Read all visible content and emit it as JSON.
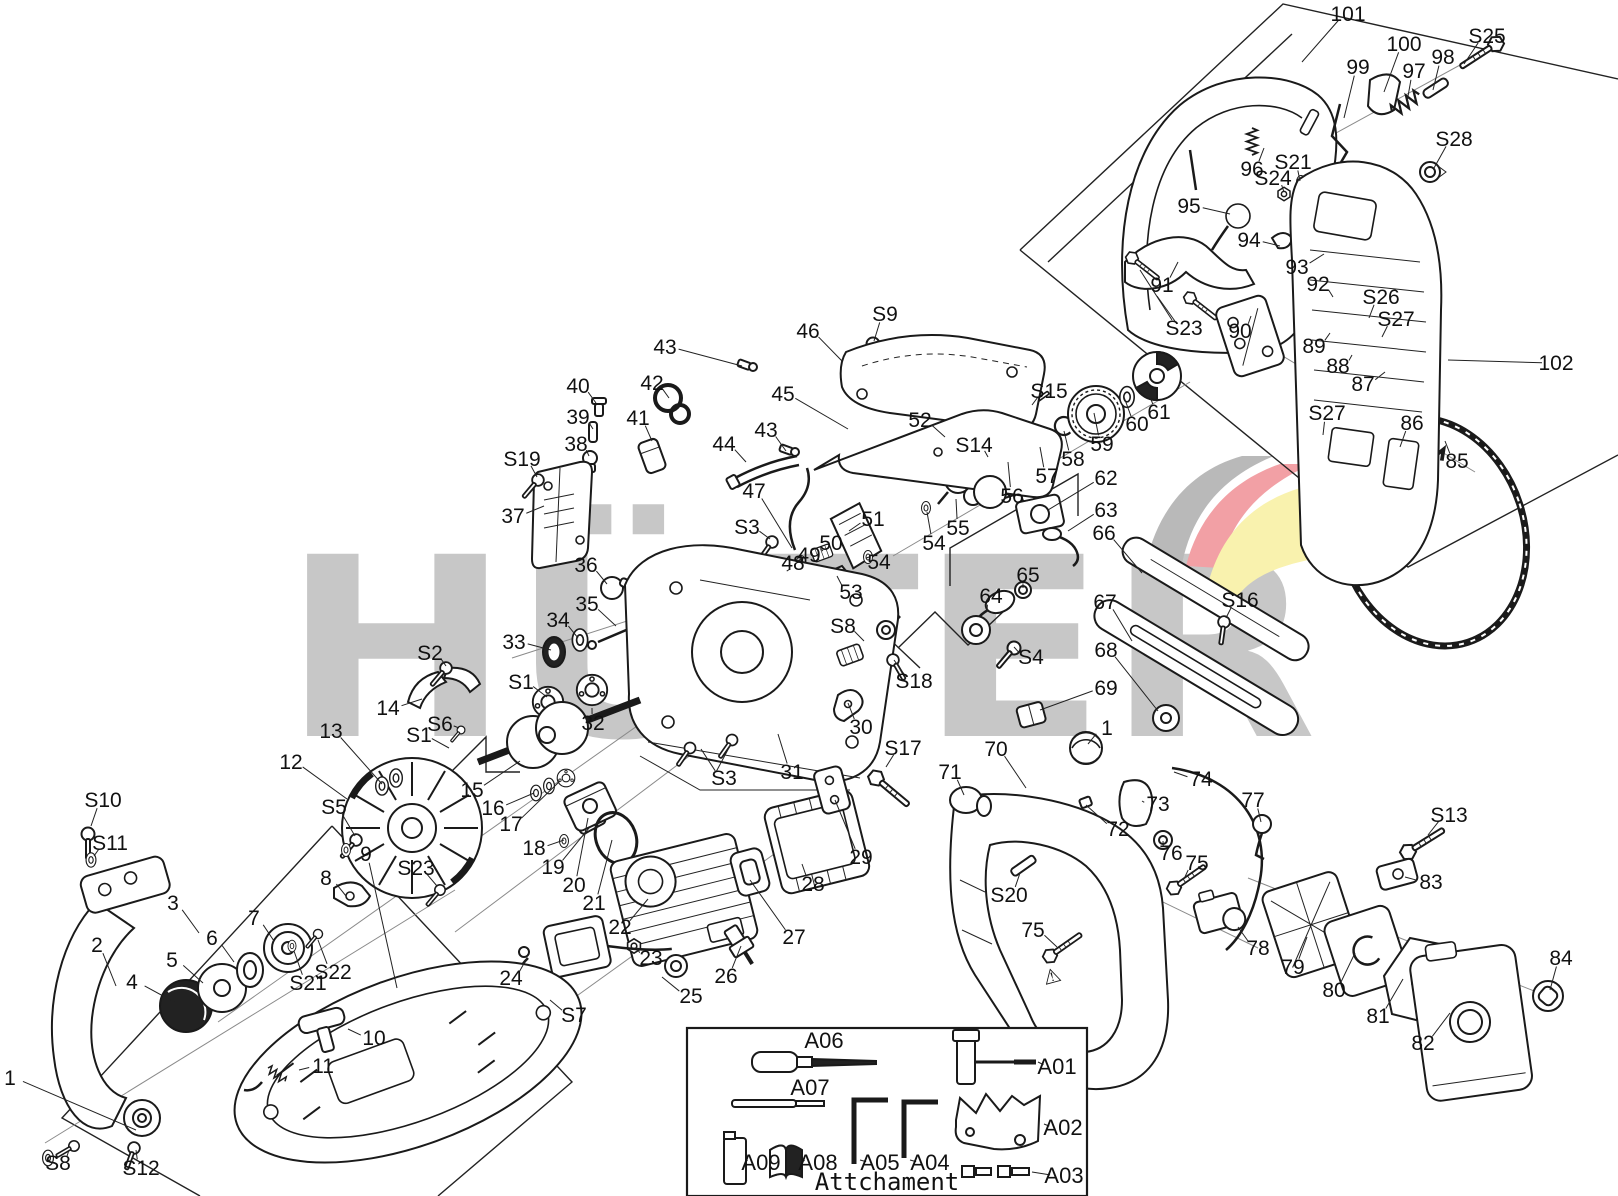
{
  "watermark": {
    "text": "HÜTER",
    "color": "#c7c7c7"
  },
  "logo_colors": {
    "gray": "#b9b9b9",
    "red": "#f2a0a5",
    "yellow": "#f9f2ae"
  },
  "attachment_box": {
    "title": "Attchament"
  },
  "part_labels": [
    {
      "id": "101",
      "x": 1348,
      "y": 14,
      "tx": 1302,
      "ty": 62
    },
    {
      "id": "100",
      "x": 1404,
      "y": 44,
      "tx": 1384,
      "ty": 92
    },
    {
      "id": "99",
      "x": 1358,
      "y": 67,
      "tx": 1344,
      "ty": 118
    },
    {
      "id": "97",
      "x": 1414,
      "y": 71,
      "tx": 1407,
      "ty": 102
    },
    {
      "id": "98",
      "x": 1443,
      "y": 57,
      "tx": 1433,
      "ty": 90
    },
    {
      "id": "S25",
      "x": 1487,
      "y": 36,
      "tx": 1464,
      "ty": 64
    },
    {
      "id": "S28",
      "x": 1454,
      "y": 139,
      "tx": 1434,
      "ty": 168
    },
    {
      "id": "96",
      "x": 1252,
      "y": 169,
      "tx": 1264,
      "ty": 148
    },
    {
      "id": "S24",
      "x": 1273,
      "y": 178,
      "tx": 1284,
      "ty": 192
    },
    {
      "id": "S21",
      "x": 1293,
      "y": 162,
      "tx": 1300,
      "ty": 181
    },
    {
      "id": "95",
      "x": 1189,
      "y": 206,
      "tx": 1230,
      "ty": 214
    },
    {
      "id": "94",
      "x": 1249,
      "y": 240,
      "tx": 1280,
      "ty": 246
    },
    {
      "id": "93",
      "x": 1297,
      "y": 267,
      "tx": 1324,
      "ty": 254
    },
    {
      "id": "92",
      "x": 1318,
      "y": 284,
      "tx": 1333,
      "ty": 297
    },
    {
      "id": "S26",
      "x": 1381,
      "y": 297,
      "tx": 1369,
      "ty": 318
    },
    {
      "id": "S27",
      "x": 1396,
      "y": 319,
      "tx": 1382,
      "ty": 337
    },
    {
      "id": "91",
      "x": 1162,
      "y": 285,
      "tx": 1178,
      "ty": 262
    },
    {
      "id": "S23",
      "x": 1184,
      "y": 328,
      "tx": 1157,
      "ty": 296
    },
    {
      "id": "90",
      "x": 1240,
      "y": 331,
      "tx": 1251,
      "ty": 316
    },
    {
      "id": "89",
      "x": 1314,
      "y": 346,
      "tx": 1330,
      "ty": 333
    },
    {
      "id": "88",
      "x": 1338,
      "y": 366,
      "tx": 1352,
      "ty": 355
    },
    {
      "id": "87",
      "x": 1363,
      "y": 384,
      "tx": 1385,
      "ty": 372
    },
    {
      "id": "102",
      "x": 1556,
      "y": 363,
      "tx": 1448,
      "ty": 360
    },
    {
      "id": "S27",
      "x": 1327,
      "y": 413,
      "tx": 1323,
      "ty": 435
    },
    {
      "id": "86",
      "x": 1412,
      "y": 423,
      "tx": 1400,
      "ty": 447
    },
    {
      "id": "85",
      "x": 1457,
      "y": 461,
      "tx": 1445,
      "ty": 441
    },
    {
      "id": "61",
      "x": 1159,
      "y": 412,
      "tx": 1146,
      "ty": 386
    },
    {
      "id": "60",
      "x": 1137,
      "y": 424,
      "tx": 1124,
      "ty": 397
    },
    {
      "id": "59",
      "x": 1102,
      "y": 444,
      "tx": 1094,
      "ty": 413
    },
    {
      "id": "58",
      "x": 1073,
      "y": 459,
      "tx": 1064,
      "ty": 431
    },
    {
      "id": "57",
      "x": 1047,
      "y": 476,
      "tx": 1040,
      "ty": 447
    },
    {
      "id": "56",
      "x": 1012,
      "y": 496,
      "tx": 1008,
      "ty": 462
    },
    {
      "id": "S15",
      "x": 1049,
      "y": 391,
      "tx": 1032,
      "ty": 405
    },
    {
      "id": "S14",
      "x": 974,
      "y": 445,
      "tx": 988,
      "ty": 457
    },
    {
      "id": "52",
      "x": 920,
      "y": 420,
      "tx": 945,
      "ty": 437
    },
    {
      "id": "55",
      "x": 958,
      "y": 528,
      "tx": 956,
      "ty": 499
    },
    {
      "id": "54",
      "x": 934,
      "y": 543,
      "tx": 927,
      "ty": 512
    },
    {
      "id": "54",
      "x": 879,
      "y": 562,
      "tx": 869,
      "ty": 557
    },
    {
      "id": "53",
      "x": 851,
      "y": 592,
      "tx": 837,
      "ty": 576
    },
    {
      "id": "62",
      "x": 1106,
      "y": 478,
      "tx": 1048,
      "ty": 510
    },
    {
      "id": "63",
      "x": 1106,
      "y": 510,
      "tx": 1068,
      "ty": 531
    },
    {
      "id": "66",
      "x": 1104,
      "y": 533,
      "tx": 1142,
      "ty": 573
    },
    {
      "id": "67",
      "x": 1105,
      "y": 602,
      "tx": 1132,
      "ty": 641
    },
    {
      "id": "68",
      "x": 1106,
      "y": 650,
      "tx": 1158,
      "ty": 711
    },
    {
      "id": "S16",
      "x": 1240,
      "y": 600,
      "tx": 1226,
      "ty": 618
    },
    {
      "id": "65",
      "x": 1028,
      "y": 575,
      "tx": 1023,
      "ty": 588
    },
    {
      "id": "64",
      "x": 991,
      "y": 596,
      "tx": 987,
      "ty": 611
    },
    {
      "id": "S4",
      "x": 1031,
      "y": 657,
      "tx": 1014,
      "ty": 647
    },
    {
      "id": "69",
      "x": 1106,
      "y": 688,
      "tx": 1040,
      "ty": 710
    },
    {
      "id": "1",
      "x": 1107,
      "y": 728,
      "tx": 1088,
      "ty": 744
    },
    {
      "id": "70",
      "x": 996,
      "y": 749,
      "tx": 1026,
      "ty": 788
    },
    {
      "id": "71",
      "x": 950,
      "y": 772,
      "tx": 964,
      "ty": 795
    },
    {
      "id": "74",
      "x": 1201,
      "y": 779,
      "tx": 1174,
      "ty": 772
    },
    {
      "id": "73",
      "x": 1158,
      "y": 804,
      "tx": 1142,
      "ty": 801
    },
    {
      "id": "72",
      "x": 1118,
      "y": 829,
      "tx": 1086,
      "ty": 805
    },
    {
      "id": "77",
      "x": 1253,
      "y": 800,
      "tx": 1261,
      "ty": 822
    },
    {
      "id": "S20",
      "x": 1009,
      "y": 895,
      "tx": 1020,
      "ty": 873
    },
    {
      "id": "76",
      "x": 1171,
      "y": 853,
      "tx": 1163,
      "ty": 841
    },
    {
      "id": "75",
      "x": 1197,
      "y": 863,
      "tx": 1184,
      "ty": 879
    },
    {
      "id": "75",
      "x": 1033,
      "y": 930,
      "tx": 1057,
      "ty": 947
    },
    {
      "id": "78",
      "x": 1258,
      "y": 948,
      "tx": 1238,
      "ty": 927
    },
    {
      "id": "S13",
      "x": 1449,
      "y": 815,
      "tx": 1428,
      "ty": 835
    },
    {
      "id": "83",
      "x": 1431,
      "y": 882,
      "tx": 1405,
      "ty": 877
    },
    {
      "id": "79",
      "x": 1293,
      "y": 967,
      "tx": 1307,
      "ty": 937
    },
    {
      "id": "80",
      "x": 1334,
      "y": 990,
      "tx": 1355,
      "ty": 953
    },
    {
      "id": "81",
      "x": 1378,
      "y": 1016,
      "tx": 1403,
      "ty": 979
    },
    {
      "id": "82",
      "x": 1423,
      "y": 1043,
      "tx": 1450,
      "ty": 1013
    },
    {
      "id": "84",
      "x": 1561,
      "y": 958,
      "tx": 1550,
      "ty": 990
    },
    {
      "id": "S9",
      "x": 885,
      "y": 314,
      "tx": 874,
      "ty": 341
    },
    {
      "id": "46",
      "x": 808,
      "y": 331,
      "tx": 842,
      "ty": 361
    },
    {
      "id": "43",
      "x": 665,
      "y": 347,
      "tx": 742,
      "ty": 366
    },
    {
      "id": "42",
      "x": 652,
      "y": 383,
      "tx": 669,
      "ty": 398
    },
    {
      "id": "40",
      "x": 578,
      "y": 386,
      "tx": 596,
      "ty": 403
    },
    {
      "id": "39",
      "x": 578,
      "y": 417,
      "tx": 593,
      "ty": 429
    },
    {
      "id": "38",
      "x": 576,
      "y": 444,
      "tx": 589,
      "ty": 456
    },
    {
      "id": "41",
      "x": 638,
      "y": 418,
      "tx": 652,
      "ty": 441
    },
    {
      "id": "44",
      "x": 724,
      "y": 444,
      "tx": 746,
      "ty": 462
    },
    {
      "id": "45",
      "x": 783,
      "y": 394,
      "tx": 848,
      "ty": 429
    },
    {
      "id": "43",
      "x": 766,
      "y": 430,
      "tx": 786,
      "ty": 451
    },
    {
      "id": "47",
      "x": 754,
      "y": 491,
      "tx": 792,
      "ty": 548
    },
    {
      "id": "S3",
      "x": 747,
      "y": 527,
      "tx": 770,
      "ty": 539
    },
    {
      "id": "51",
      "x": 873,
      "y": 519,
      "tx": 849,
      "ty": 531
    },
    {
      "id": "50",
      "x": 831,
      "y": 543,
      "tx": 823,
      "ty": 551
    },
    {
      "id": "49",
      "x": 809,
      "y": 555,
      "tx": 802,
      "ty": 560
    },
    {
      "id": "48",
      "x": 793,
      "y": 563,
      "tx": 790,
      "ty": 569
    },
    {
      "id": "S19",
      "x": 522,
      "y": 459,
      "tx": 537,
      "ty": 477
    },
    {
      "id": "37",
      "x": 513,
      "y": 516,
      "tx": 544,
      "ty": 506
    },
    {
      "id": "36",
      "x": 586,
      "y": 565,
      "tx": 607,
      "ty": 584
    },
    {
      "id": "35",
      "x": 587,
      "y": 604,
      "tx": 616,
      "ty": 626
    },
    {
      "id": "34",
      "x": 558,
      "y": 620,
      "tx": 578,
      "ty": 638
    },
    {
      "id": "33",
      "x": 514,
      "y": 642,
      "tx": 551,
      "ty": 650
    },
    {
      "id": "S2",
      "x": 430,
      "y": 653,
      "tx": 446,
      "ty": 666
    },
    {
      "id": "14",
      "x": 388,
      "y": 708,
      "tx": 422,
      "ty": 699
    },
    {
      "id": "S6",
      "x": 440,
      "y": 724,
      "tx": 459,
      "ty": 728
    },
    {
      "id": "S1",
      "x": 521,
      "y": 682,
      "tx": 547,
      "ty": 697
    },
    {
      "id": "S1",
      "x": 419,
      "y": 735,
      "tx": 449,
      "ty": 748
    },
    {
      "id": "13",
      "x": 331,
      "y": 731,
      "tx": 382,
      "ty": 784
    },
    {
      "id": "12",
      "x": 291,
      "y": 762,
      "tx": 347,
      "ty": 799
    },
    {
      "id": "S5",
      "x": 334,
      "y": 807,
      "tx": 355,
      "ty": 836
    },
    {
      "id": "15",
      "x": 472,
      "y": 790,
      "tx": 520,
      "ty": 761
    },
    {
      "id": "16",
      "x": 493,
      "y": 808,
      "tx": 534,
      "ty": 793
    },
    {
      "id": "17",
      "x": 511,
      "y": 824,
      "tx": 560,
      "ty": 781
    },
    {
      "id": "18",
      "x": 534,
      "y": 848,
      "tx": 564,
      "ty": 840
    },
    {
      "id": "19",
      "x": 553,
      "y": 867,
      "tx": 589,
      "ty": 828
    },
    {
      "id": "20",
      "x": 574,
      "y": 885,
      "tx": 588,
      "ty": 818
    },
    {
      "id": "21",
      "x": 594,
      "y": 903,
      "tx": 612,
      "ty": 840
    },
    {
      "id": "22",
      "x": 620,
      "y": 927,
      "tx": 648,
      "ty": 899
    },
    {
      "id": "23",
      "x": 651,
      "y": 958,
      "tx": 636,
      "ty": 947
    },
    {
      "id": "24",
      "x": 511,
      "y": 978,
      "tx": 527,
      "ty": 958
    },
    {
      "id": "25",
      "x": 691,
      "y": 996,
      "tx": 662,
      "ty": 977
    },
    {
      "id": "S7",
      "x": 574,
      "y": 1015,
      "tx": 550,
      "ty": 1000
    },
    {
      "id": "26",
      "x": 726,
      "y": 976,
      "tx": 741,
      "ty": 946
    },
    {
      "id": "27",
      "x": 794,
      "y": 937,
      "tx": 750,
      "ty": 880
    },
    {
      "id": "28",
      "x": 813,
      "y": 884,
      "tx": 802,
      "ty": 864
    },
    {
      "id": "29",
      "x": 861,
      "y": 857,
      "tx": 835,
      "ty": 800
    },
    {
      "id": "S17",
      "x": 903,
      "y": 748,
      "tx": 886,
      "ty": 767
    },
    {
      "id": "S8",
      "x": 843,
      "y": 626,
      "tx": 864,
      "ty": 641
    },
    {
      "id": "S18",
      "x": 914,
      "y": 681,
      "tx": 894,
      "ty": 660
    },
    {
      "id": "30",
      "x": 861,
      "y": 727,
      "tx": 848,
      "ty": 703
    },
    {
      "id": "31",
      "x": 792,
      "y": 772,
      "tx": 778,
      "ty": 734
    },
    {
      "id": "S3",
      "x": 724,
      "y": 778,
      "tx": 701,
      "ty": 749
    },
    {
      "id": "32",
      "x": 593,
      "y": 723,
      "tx": 592,
      "ty": 708
    },
    {
      "id": "1",
      "x": 10,
      "y": 1078,
      "tx": 136,
      "ty": 1130
    },
    {
      "id": "S8",
      "x": 58,
      "y": 1163,
      "tx": 69,
      "ty": 1150
    },
    {
      "id": "S12",
      "x": 141,
      "y": 1168,
      "tx": 136,
      "ty": 1150
    },
    {
      "id": "2",
      "x": 97,
      "y": 945,
      "tx": 116,
      "ty": 986
    },
    {
      "id": "3",
      "x": 173,
      "y": 903,
      "tx": 199,
      "ty": 933
    },
    {
      "id": "5",
      "x": 172,
      "y": 960,
      "tx": 203,
      "ty": 983
    },
    {
      "id": "4",
      "x": 132,
      "y": 982,
      "tx": 176,
      "ty": 1003
    },
    {
      "id": "6",
      "x": 212,
      "y": 938,
      "tx": 234,
      "ty": 962
    },
    {
      "id": "7",
      "x": 254,
      "y": 918,
      "tx": 274,
      "ty": 941
    },
    {
      "id": "8",
      "x": 326,
      "y": 878,
      "tx": 346,
      "ty": 896
    },
    {
      "id": "9",
      "x": 366,
      "y": 854,
      "tx": 397,
      "ty": 988
    },
    {
      "id": "S23",
      "x": 416,
      "y": 868,
      "tx": 437,
      "ty": 886
    },
    {
      "id": "S21",
      "x": 308,
      "y": 983,
      "tx": 294,
      "ty": 951
    },
    {
      "id": "S22",
      "x": 333,
      "y": 972,
      "tx": 318,
      "ty": 940
    },
    {
      "id": "10",
      "x": 374,
      "y": 1038,
      "tx": 348,
      "ty": 1029
    },
    {
      "id": "11",
      "x": 323,
      "y": 1066,
      "tx": 299,
      "ty": 1070
    },
    {
      "id": "S10",
      "x": 103,
      "y": 800,
      "tx": 91,
      "ty": 826
    },
    {
      "id": "S11",
      "x": 110,
      "y": 843,
      "tx": 94,
      "ty": 856
    }
  ],
  "tool_labels": [
    {
      "id": "A06",
      "x": 824,
      "y": 1041,
      "tx": 824,
      "ty": 1041
    },
    {
      "id": "A07",
      "x": 810,
      "y": 1088,
      "tx": 810,
      "ty": 1088
    },
    {
      "id": "A09",
      "x": 761,
      "y": 1163,
      "tx": 747,
      "ty": 1160
    },
    {
      "id": "A08",
      "x": 818,
      "y": 1163,
      "tx": 804,
      "ty": 1160
    },
    {
      "id": "A05",
      "x": 880,
      "y": 1163,
      "tx": 860,
      "ty": 1160
    },
    {
      "id": "A04",
      "x": 930,
      "y": 1163,
      "tx": 910,
      "ty": 1160
    },
    {
      "id": "A01",
      "x": 1057,
      "y": 1067,
      "tx": 1038,
      "ty": 1062
    },
    {
      "id": "A02",
      "x": 1063,
      "y": 1128,
      "tx": 1044,
      "ty": 1124
    },
    {
      "id": "A03",
      "x": 1064,
      "y": 1176,
      "tx": 1032,
      "ty": 1172
    }
  ]
}
